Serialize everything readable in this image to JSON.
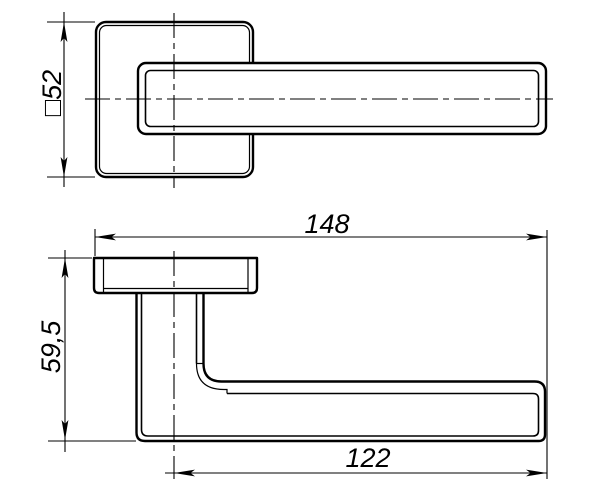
{
  "drawing": {
    "background": "#ffffff",
    "line_color": "#000000"
  },
  "dimensions": {
    "rosette_square": "□52",
    "overall_length": "148",
    "grip_length": "122",
    "overall_height": "59,5"
  }
}
